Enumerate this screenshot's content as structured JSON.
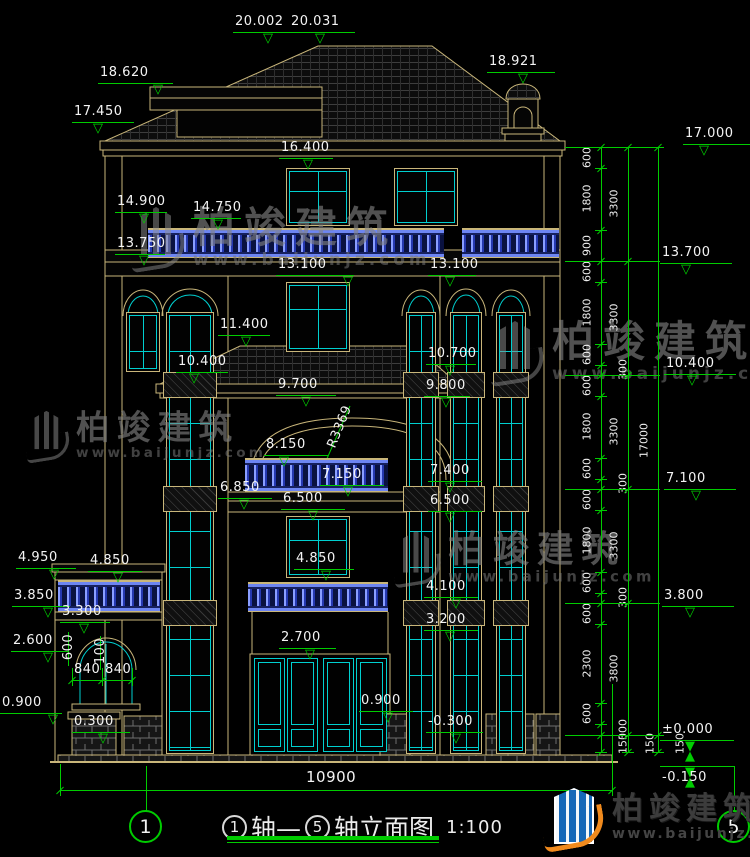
{
  "drawing": {
    "title": {
      "axis_from": "1",
      "mid": "轴—",
      "axis_to": "5",
      "name": "轴立面图",
      "scale": "1:100"
    },
    "axis_bubbles": {
      "left": "1",
      "right": "5"
    },
    "watermark": {
      "name": "柏竣建筑",
      "url": "www.baijunjz.com"
    },
    "brand": {
      "name": "柏竣建筑",
      "url": "www.baijunjz.com"
    },
    "colors": {
      "line": "#c9b67a",
      "glass": "#00cfcf",
      "dimension": "#00cc00",
      "rail_blue": "#2538b0",
      "text": "#f4f4f4"
    },
    "elevation_markers": [
      {
        "label": "20.002",
        "x": 233,
        "w": 72,
        "y": 32,
        "tip": 270
      },
      {
        "label": "20.031",
        "x": 289,
        "w": 66,
        "y": 32,
        "tip": 322
      },
      {
        "label": "18.620",
        "x": 98,
        "w": 75,
        "y": 83,
        "tip": 160
      },
      {
        "label": "17.450",
        "x": 72,
        "w": 62,
        "y": 122,
        "tip": 100
      },
      {
        "label": "18.921",
        "x": 487,
        "w": 68,
        "y": 72,
        "tip": 525
      },
      {
        "label": "16.400",
        "x": 279,
        "w": 54,
        "y": 158,
        "tip": 310
      },
      {
        "label": "14.900",
        "x": 115,
        "w": 52,
        "y": 212,
        "tip": 146
      },
      {
        "label": "14.750",
        "x": 191,
        "w": 50,
        "y": 218,
        "tip": 220
      },
      {
        "label": "13.750",
        "x": 115,
        "w": 50,
        "y": 254,
        "tip": 146
      },
      {
        "label": "13.100",
        "x": 276,
        "w": 78,
        "y": 275,
        "tip": 350
      },
      {
        "label": "13.100",
        "x": 428,
        "w": 48,
        "y": 275,
        "tip": 452
      },
      {
        "label": "11.400",
        "x": 218,
        "w": 52,
        "y": 335,
        "tip": 248
      },
      {
        "label": "10.400",
        "x": 176,
        "w": 52,
        "y": 372,
        "tip": 196
      },
      {
        "label": "10.700",
        "x": 426,
        "w": 50,
        "y": 364,
        "tip": 452
      },
      {
        "label": "9.800",
        "x": 424,
        "w": 46,
        "y": 396,
        "tip": 448
      },
      {
        "label": "9.700",
        "x": 276,
        "w": 60,
        "y": 395,
        "tip": 308
      },
      {
        "label": "8.150",
        "x": 264,
        "w": 64,
        "y": 455,
        "tip": 286
      },
      {
        "label": "7.150",
        "x": 320,
        "w": 64,
        "y": 485,
        "tip": 350
      },
      {
        "label": "6.850",
        "x": 218,
        "w": 54,
        "y": 498,
        "tip": 246
      },
      {
        "label": "6.500",
        "x": 281,
        "w": 64,
        "y": 509,
        "tip": 315
      },
      {
        "label": "7.400",
        "x": 428,
        "w": 54,
        "y": 481,
        "tip": 452
      },
      {
        "label": "6.500",
        "x": 428,
        "w": 54,
        "y": 511,
        "tip": 452
      },
      {
        "label": "4.950",
        "x": 16,
        "w": 60,
        "y": 568,
        "tip": 56
      },
      {
        "label": "4.850",
        "x": 88,
        "w": 54,
        "y": 571,
        "tip": 120
      },
      {
        "label": "4.850",
        "x": 294,
        "w": 60,
        "y": 569,
        "tip": 328
      },
      {
        "label": "3.850",
        "x": 12,
        "w": 58,
        "y": 606,
        "tip": 50
      },
      {
        "label": "3.300",
        "x": 60,
        "w": 50,
        "y": 622,
        "tip": 86
      },
      {
        "label": "2.600",
        "x": 11,
        "w": 57,
        "y": 651,
        "tip": 50
      },
      {
        "label": "2.700",
        "x": 279,
        "w": 57,
        "y": 648,
        "tip": 312
      },
      {
        "label": "4.100",
        "x": 424,
        "w": 54,
        "y": 597,
        "tip": 458
      },
      {
        "label": "3.200",
        "x": 424,
        "w": 54,
        "y": 630,
        "tip": 452
      },
      {
        "label": "0.900",
        "x": 0,
        "w": 62,
        "y": 713,
        "tip": 55
      },
      {
        "label": "0.300",
        "x": 72,
        "w": 58,
        "y": 732,
        "tip": 105
      },
      {
        "label": "0.900",
        "x": 359,
        "w": 54,
        "y": 711,
        "tip": 390
      },
      {
        "label": "-0.300",
        "x": 426,
        "w": 57,
        "y": 732,
        "tip": 458
      },
      {
        "label": "17.000",
        "x": 683,
        "w": 67,
        "y": 144,
        "tip": 706
      },
      {
        "label": "13.700",
        "x": 660,
        "w": 72,
        "y": 263,
        "tip": 688
      },
      {
        "label": "10.400",
        "x": 664,
        "w": 72,
        "y": 374,
        "tip": 694
      },
      {
        "label": "7.100",
        "x": 664,
        "w": 72,
        "y": 489,
        "tip": 698
      },
      {
        "label": "3.800",
        "x": 662,
        "w": 72,
        "y": 606,
        "tip": 692
      },
      {
        "label": "±0.000",
        "x": 660,
        "w": 74,
        "y": 740,
        "tip": 692,
        "style": "filled"
      },
      {
        "label": "-0.150",
        "x": 660,
        "w": 74,
        "y": 766,
        "tip": 692,
        "style": "filled",
        "text_below": true
      }
    ],
    "dim_chains": [
      {
        "x": 601,
        "ticks": [
          147,
          168,
          230,
          261,
          282,
          344,
          365,
          375,
          396,
          458,
          479,
          489,
          510,
          572,
          593,
          603,
          624,
          703,
          724,
          735,
          752
        ],
        "labels": [
          "600",
          "1800",
          "900",
          "600",
          "1800",
          "600",
          "300",
          "600",
          "1800",
          "600",
          "300",
          "600",
          "1800",
          "600",
          "300",
          "600",
          "2300",
          "600",
          "300",
          "150"
        ]
      },
      {
        "x": 628,
        "ticks": [
          147,
          261,
          375,
          489,
          603,
          735,
          752
        ],
        "labels": [
          "3300",
          "3300",
          "3300",
          "3300",
          "3800",
          "150"
        ]
      },
      {
        "x": 658,
        "ticks": [
          147,
          735,
          752
        ],
        "labels": [
          "17000",
          "150"
        ]
      }
    ],
    "small_dims": {
      "dim840": {
        "labels": [
          "840",
          "840"
        ],
        "y": 680,
        "x1": 72,
        "mid": 102,
        "x2": 132
      },
      "rotated": [
        {
          "label": "600",
          "x": 56,
          "y": 640
        },
        {
          "label": "100",
          "x": 88,
          "y": 644
        }
      ],
      "radius": {
        "label": "R3369",
        "x": 318,
        "y": 420,
        "angle": -68
      },
      "overall": {
        "label": "10900",
        "x1": 60,
        "x2": 612,
        "y": 790,
        "tx": 306,
        "ty": 770
      }
    }
  }
}
